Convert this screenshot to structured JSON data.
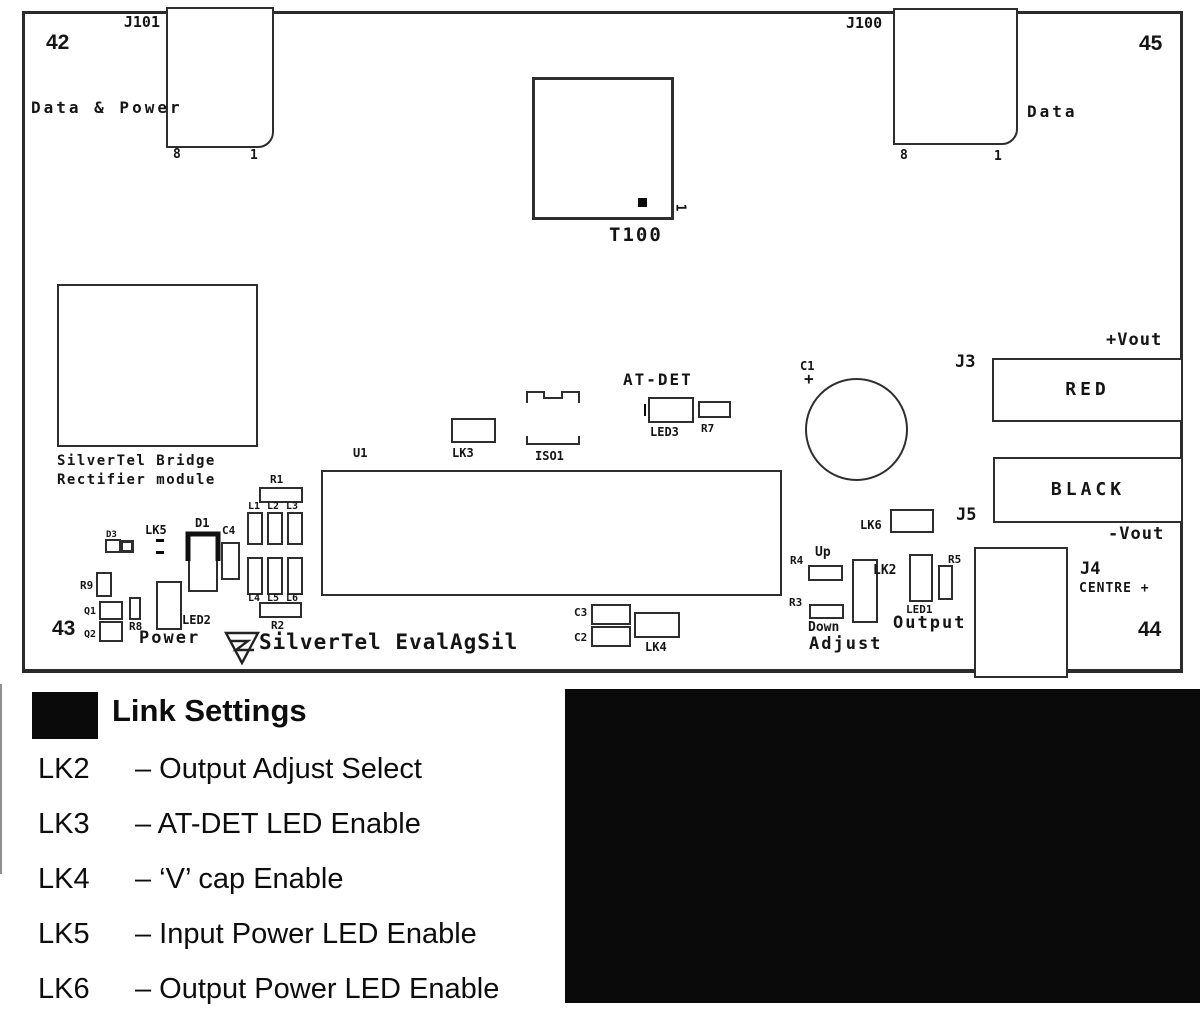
{
  "colors": {
    "line": "#2e2e2e",
    "text": "#151515",
    "black": "#000000",
    "background": "#ffffff"
  },
  "board": {
    "corner_42": "42",
    "corner_43": "43",
    "corner_44": "44",
    "corner_45": "45",
    "j101": {
      "ref": "J101",
      "desc": "Data & Power",
      "pin_8": "8",
      "pin_1": "1"
    },
    "j100": {
      "ref": "J100",
      "desc": "Data",
      "pin_8": "8",
      "pin_1": "1"
    },
    "t100": {
      "ref": "T100",
      "pin_1": "1"
    },
    "bridge": {
      "line1": "SilverTel Bridge",
      "line2": "Rectifier module"
    },
    "refs": {
      "u1": "U1",
      "lk3": "LK3",
      "iso1": "ISO1",
      "at_det": "AT-DET",
      "led3": "LED3",
      "r7": "R7",
      "c1": "C1",
      "c1_polarity": "+",
      "j3": "J3",
      "red": "RED",
      "vout_plus": "+Vout",
      "black": "BLACK",
      "j5": "J5",
      "vout_minus": "-Vout",
      "lk6": "LK6",
      "r4": "R4",
      "up": "Up",
      "r3": "R3",
      "down": "Down",
      "adjust": "Adjust",
      "lk2": "LK2",
      "led1": "LED1",
      "r5": "R5",
      "output": "Output",
      "j4": "J4",
      "centre": "CENTRE +",
      "d3": "D3",
      "lk5": "LK5",
      "d1": "D1",
      "c4": "C4",
      "r1": "R1",
      "l1": "L1",
      "l2": "L2",
      "l3": "L3",
      "l4": "L4",
      "l5": "L5",
      "l6": "L6",
      "r2": "R2",
      "r9": "R9",
      "q1": "Q1",
      "q2": "Q2",
      "r8": "R8",
      "led2": "LED2",
      "power": "Power",
      "c3": "C3",
      "c2": "C2",
      "lk4": "LK4"
    },
    "brand": "SilverTel EvalAgSil"
  },
  "legend": {
    "title": "Link Settings",
    "items": [
      {
        "ref": "LK2",
        "desc": "– Output Adjust Select"
      },
      {
        "ref": "LK3",
        "desc": "– AT-DET LED Enable"
      },
      {
        "ref": "LK4",
        "desc": "– ‘V’ cap Enable"
      },
      {
        "ref": "LK5",
        "desc": "– Input Power LED Enable"
      },
      {
        "ref": "LK6",
        "desc": "– Output Power LED Enable"
      }
    ]
  }
}
